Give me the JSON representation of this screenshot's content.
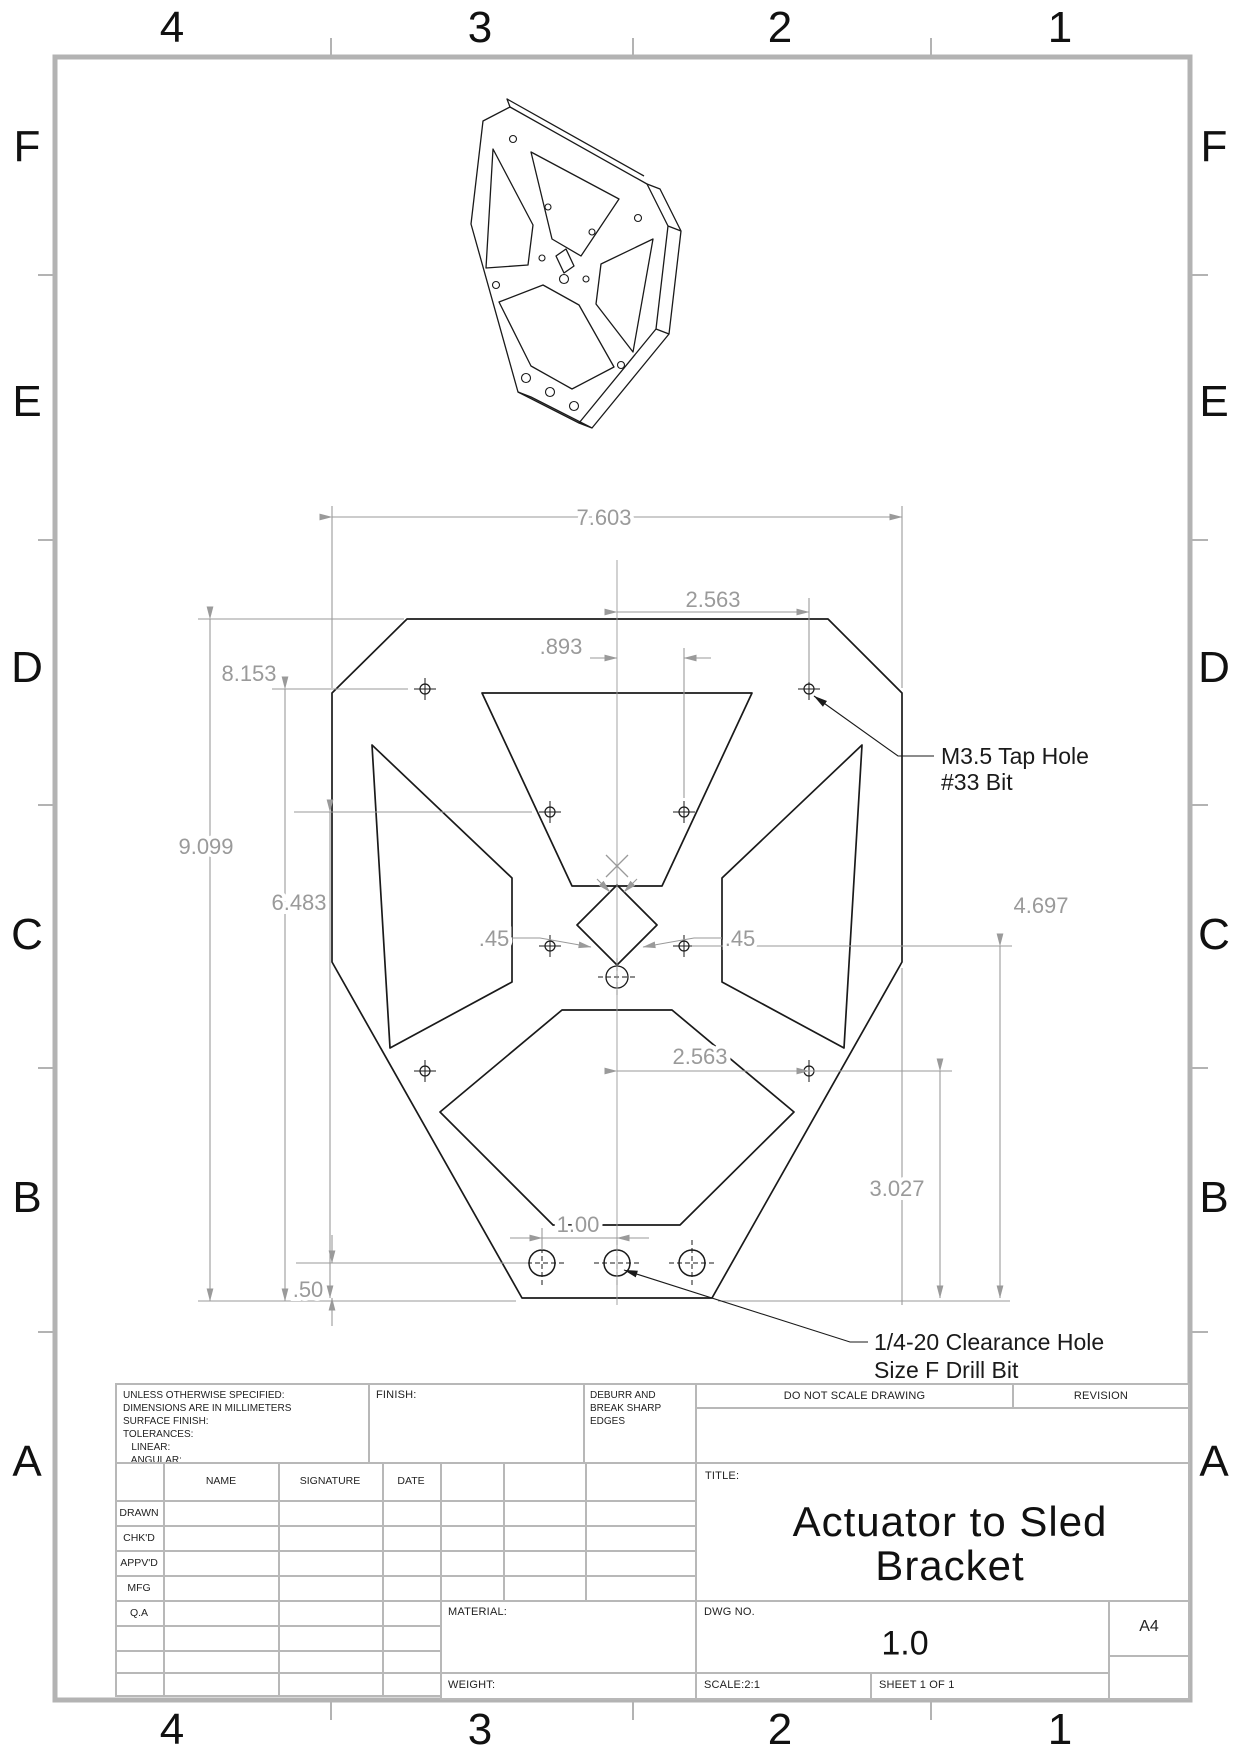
{
  "grid": {
    "cols": [
      "4",
      "3",
      "2",
      "1"
    ],
    "rows": [
      "F",
      "E",
      "D",
      "C",
      "B",
      "A"
    ]
  },
  "dims": {
    "overall_width": "7.603",
    "tap_offset_top": "2.563",
    "inner_offset": ".893",
    "height_tap": "8.153",
    "height_overall": "9.099",
    "height_inner": "6.483",
    "square_left": ".45",
    "square_right": ".45",
    "height_right_inner": "4.697",
    "tap_offset_bottom": "2.563",
    "height_right_tap": "3.027",
    "hole_pitch": "1.00",
    "bottom_edge": ".50"
  },
  "notes": {
    "tap_line1": "M3.5 Tap Hole",
    "tap_line2": "#33 Bit",
    "clearance_line1": "1/4-20 Clearance Hole",
    "clearance_line2": "Size F Drill Bit"
  },
  "tb": {
    "tol1": "UNLESS OTHERWISE SPECIFIED:",
    "tol2": "DIMENSIONS ARE IN MILLIMETERS",
    "tol3": "SURFACE FINISH:",
    "tol4": "TOLERANCES:",
    "tol5": "   LINEAR:",
    "tol6": "   ANGULAR:",
    "finish": "FINISH:",
    "deburr1": "DEBURR AND",
    "deburr2": "BREAK SHARP",
    "deburr3": "EDGES",
    "do_not_scale": "DO NOT SCALE DRAWING",
    "revision": "REVISION",
    "name": "NAME",
    "signature": "SIGNATURE",
    "date": "DATE",
    "row_drawn": "DRAWN",
    "row_chkd": "CHK'D",
    "row_appvd": "APPV'D",
    "row_mfg": "MFG",
    "row_qa": "Q.A",
    "title_label": "TITLE:",
    "title1": "Actuator to Sled",
    "title2": "Bracket",
    "material": "MATERIAL:",
    "dwg_label": "DWG NO.",
    "dwg_no": "1.0",
    "paper_size": "A4",
    "weight": "WEIGHT:",
    "scale": "SCALE:2:1",
    "sheet": "SHEET 1 OF 1"
  }
}
